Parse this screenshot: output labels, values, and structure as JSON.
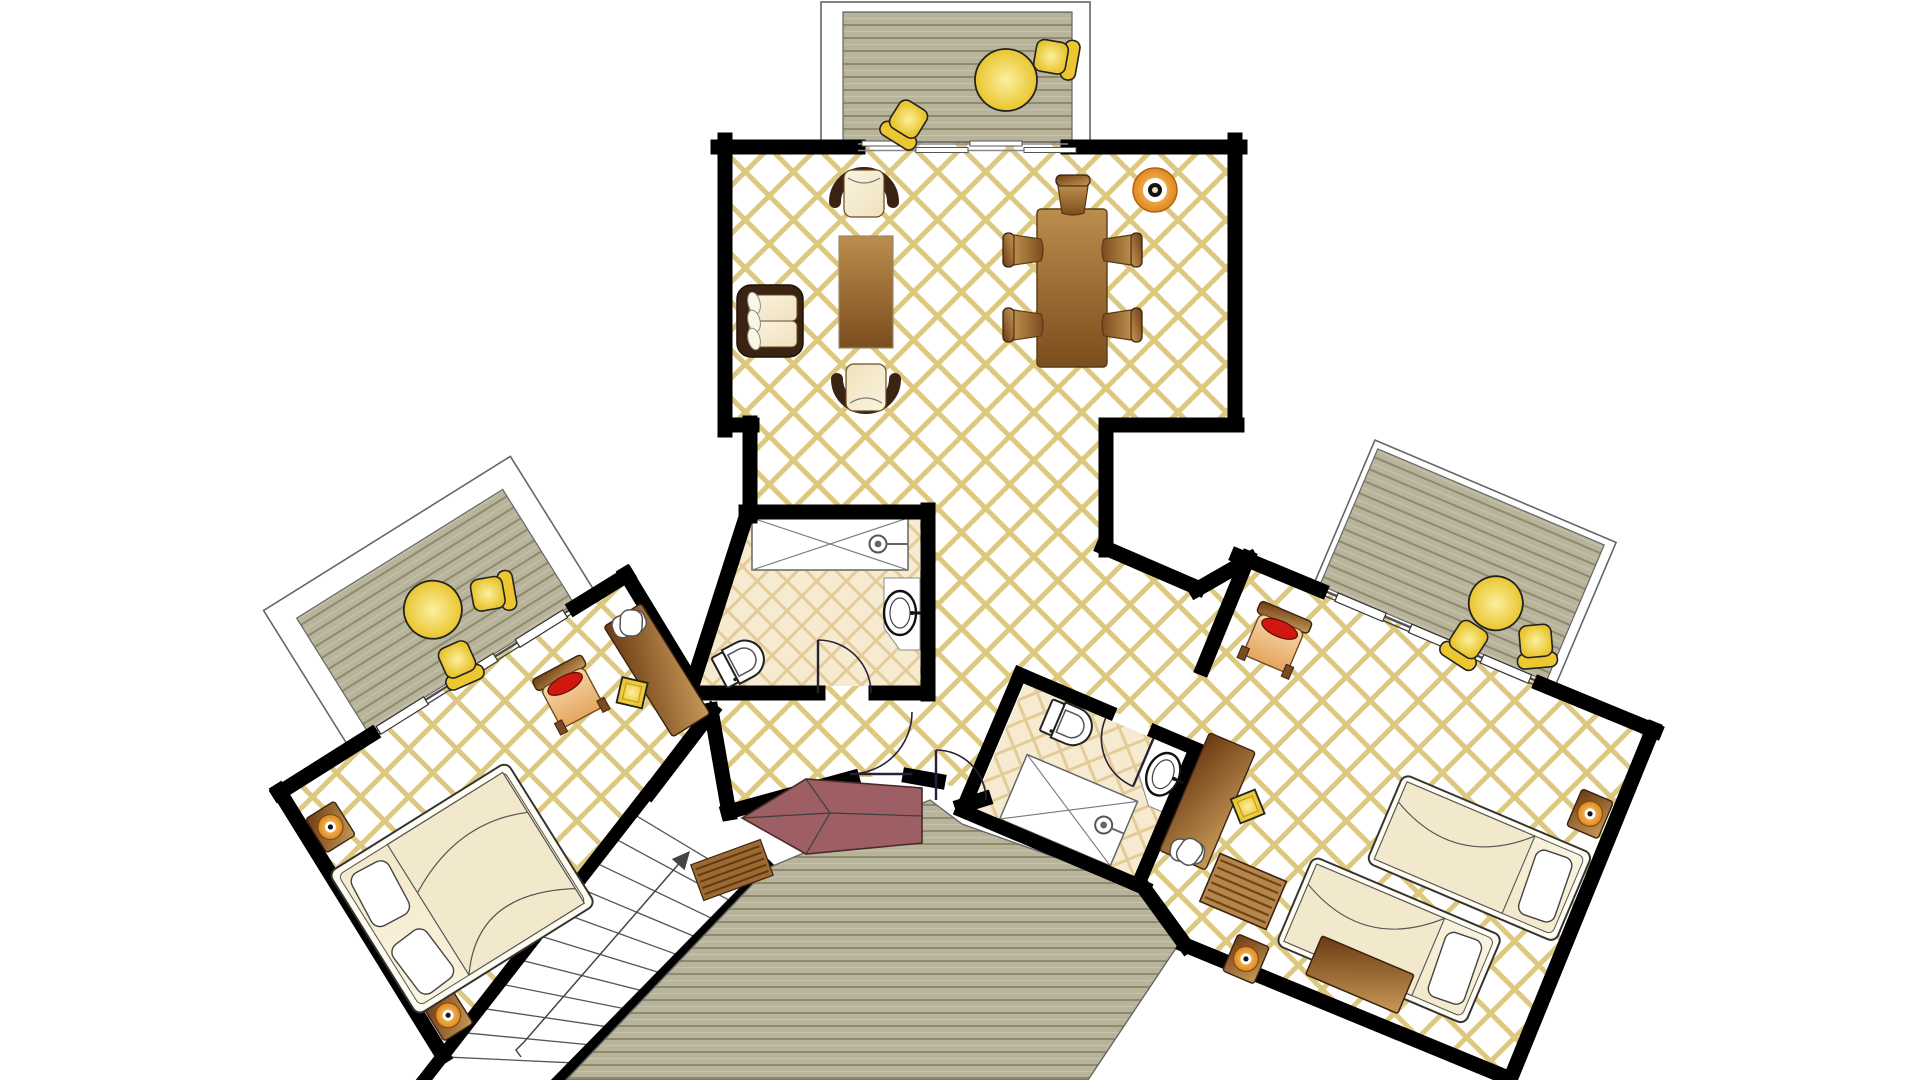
{
  "plan_title": "hotel-suite-floor-plan",
  "canvas": {
    "w": 1920,
    "h": 1080
  },
  "palette": {
    "wall": "#000000",
    "tile_line": "#dcc87e",
    "bath_bg": "#f6ebd1",
    "bath_line": "#e3cc98",
    "deck_bg": "#b8b39b",
    "deck_line": "#8e8a6b",
    "deck_hi": "#c6c2ab",
    "frame_stroke": "#666666",
    "wood_dark": "#3a2312",
    "wood_mid": "#8a5a28",
    "wood_light": "#c89a58",
    "cream_dark": "#efe1bd",
    "cream_light": "#faf4e0",
    "yellow_deep": "#e9c52e",
    "yellow_light": "#fcf0a0",
    "red_cushion": "#d01810",
    "canopy": "#9d5f63",
    "lamp_orange": "#e0871d",
    "arc_stroke": "#2a2038",
    "tread_stroke": "#555555"
  },
  "floors": {
    "main": [
      [
        725,
        140
      ],
      [
        1240,
        140
      ],
      [
        1240,
        430
      ],
      [
        1103,
        430
      ],
      [
        1103,
        548
      ],
      [
        1198,
        588
      ],
      [
        1247,
        561
      ],
      [
        1203,
        666
      ],
      [
        1208,
        752
      ],
      [
        1025,
        674
      ],
      [
        962,
        810
      ],
      [
        986,
        800
      ],
      [
        936,
        780
      ],
      [
        912,
        777
      ],
      [
        850,
        777
      ],
      [
        728,
        812
      ],
      [
        711,
        712
      ],
      [
        687,
        674
      ],
      [
        690,
        693
      ],
      [
        746,
        512
      ],
      [
        750,
        512
      ],
      [
        750,
        430
      ],
      [
        725,
        430
      ]
    ],
    "left_bedroom": [
      [
        279,
        793
      ],
      [
        626,
        576
      ],
      [
        687,
        674
      ],
      [
        711,
        712
      ],
      [
        650,
        790
      ],
      [
        443,
        1055
      ]
    ],
    "right_bedroom": [
      [
        1248,
        560
      ],
      [
        1653,
        732
      ],
      [
        1505,
        1080
      ],
      [
        1183,
        943
      ],
      [
        1144,
        888
      ],
      [
        1205,
        753
      ],
      [
        1203,
        666
      ]
    ]
  },
  "walls": [
    [
      718,
      147,
      858,
      147
    ],
    [
      1068,
      147,
      1240,
      147
    ],
    [
      725,
      140,
      725,
      430
    ],
    [
      725,
      425,
      752,
      425
    ],
    [
      750,
      423,
      750,
      516
    ],
    [
      1235,
      140,
      1235,
      425
    ],
    [
      1237,
      425,
      1106,
      425
    ],
    [
      1106,
      425,
      1106,
      550
    ],
    [
      1103,
      547,
      1198,
      588
    ],
    [
      1196,
      590,
      1250,
      559
    ],
    [
      1238,
      556,
      1320,
      590
    ],
    [
      1541,
      684,
      1655,
      731
    ],
    [
      1653,
      729,
      1510,
      1080
    ],
    [
      1508,
      1078,
      1185,
      945
    ],
    [
      1186,
      946,
      1141,
      884
    ],
    [
      1248,
      558,
      1203,
      668
    ],
    [
      962,
      806,
      984,
      799
    ],
    [
      728,
      812,
      852,
      778
    ],
    [
      910,
      776,
      938,
      781
    ],
    [
      711,
      710,
      729,
      813
    ],
    [
      279,
      793,
      371,
      735
    ],
    [
      575,
      607,
      627,
      575
    ],
    [
      626,
      574,
      688,
      676
    ],
    [
      279,
      791,
      443,
      1056
    ],
    [
      650,
      792,
      712,
      711
    ],
    [
      746,
      512,
      928,
      512
    ],
    [
      928,
      510,
      928,
      694
    ],
    [
      928,
      693,
      876,
      693
    ],
    [
      818,
      693,
      688,
      693
    ],
    [
      747,
      514,
      689,
      695
    ]
  ],
  "stairs": {
    "underlay": [
      [
        650,
        788
      ],
      [
        770,
        866
      ],
      [
        560,
        1082
      ],
      [
        422,
        1082
      ]
    ],
    "edge1": [
      650,
      790,
      424,
      1080
    ],
    "edge2": [
      768,
      868,
      560,
      1080
    ],
    "tread_t": [
      0.08,
      0.164,
      0.248,
      0.332,
      0.416,
      0.5,
      0.584,
      0.668,
      0.752,
      0.836,
      0.92
    ],
    "p_start": [
      650,
      790
    ],
    "p_vec": [
      -226,
      290
    ],
    "q_start": [
      768,
      868
    ],
    "q_vec": [
      -208,
      212
    ],
    "arrow": {
      "line": [
        524,
        1042,
        683,
        859
      ],
      "head": [
        [
          690,
          851
        ],
        [
          684.6,
          870.2
        ],
        [
          671.8,
          859
        ]
      ],
      "tail": [
        [
          524,
          1042
        ],
        [
          516,
          1050
        ],
        [
          521,
          1057
        ]
      ]
    }
  },
  "deck_top": {
    "frame": [
      821,
      2,
      269,
      140
    ],
    "deck": [
      843,
      12,
      229,
      130
    ]
  },
  "deck_bottom": [
    [
      768,
      868
    ],
    [
      930,
      800
    ],
    [
      962,
      824
    ],
    [
      1142,
      888
    ],
    [
      1180,
      942
    ],
    [
      1088,
      1080
    ],
    [
      566,
      1080
    ]
  ],
  "slide_door": {
    "rails": [
      [
        858,
        144,
        1068,
        144
      ],
      [
        858,
        150.5,
        1068,
        150.5
      ]
    ],
    "panels": [
      [
        862,
        141,
        52,
        5
      ],
      [
        916,
        147.5,
        52,
        5
      ],
      [
        970,
        141,
        52,
        5
      ],
      [
        1024,
        147.5,
        52,
        5
      ]
    ]
  },
  "bath1": {
    "floor": [
      [
        748,
        518
      ],
      [
        920,
        518
      ],
      [
        920,
        686
      ],
      [
        696,
        686
      ],
      [
        744,
        518
      ]
    ],
    "shower": [
      752,
      518,
      156,
      52
    ],
    "shower_head": [
      878,
      544
    ],
    "shower_stem": [
      886,
      544,
      908,
      544
    ],
    "vanity": [
      [
        884,
        578
      ],
      [
        920,
        578
      ],
      [
        920,
        650
      ],
      [
        900,
        650
      ],
      [
        884,
        628
      ]
    ],
    "door_leaf": [
      818,
      693,
      818,
      640
    ],
    "door_arc": "M818,640 A53,53 0 0 1 871,693"
  },
  "bath2": {
    "origin": [
      1030,
      671
    ],
    "rot": 23,
    "walls": [
      [
        -8,
        7,
        88,
        7
      ],
      [
        140,
        7,
        190,
        7
      ],
      [
        183,
        7,
        183,
        155
      ],
      [
        190,
        155,
        -8,
        155
      ],
      [
        -8,
        7,
        -8,
        155
      ]
    ],
    "floor": [
      0,
      14,
      183,
      141
    ],
    "shower": [
      30,
      78,
      120,
      70
    ],
    "shower_head": [
      128,
      113
    ],
    "shower_stem": [
      136,
      113,
      150,
      113
    ],
    "vanity": [
      [
        140,
        12
      ],
      [
        183,
        12
      ],
      [
        183,
        78
      ],
      [
        162,
        78
      ],
      [
        140,
        52
      ]
    ],
    "sink": [
      163,
      43
    ],
    "toilet": [
      60,
      34
    ],
    "door_leaf": [
      140,
      14,
      140,
      66
    ],
    "door_arc": "M88,14 A52,52 0 0 0 140,66"
  },
  "hall_doors": [
    {
      "leaf": [
        850,
        774,
        912,
        774
      ],
      "arc": "M850,774 A62,62 0 0 0 912,712"
    },
    {
      "leaf": [
        936,
        750,
        936,
        800
      ],
      "arc": "M936,750 A50,50 0 0 1 986,800"
    }
  ],
  "canopy": {
    "poly": [
      [
        742,
        818
      ],
      [
        806,
        779
      ],
      [
        922,
        788
      ],
      [
        922,
        843
      ],
      [
        806,
        854
      ]
    ],
    "ridges": [
      [
        742,
        818,
        830,
        813
      ],
      [
        806,
        779,
        830,
        813
      ],
      [
        806,
        854,
        830,
        813
      ],
      [
        830,
        813,
        922,
        816
      ]
    ]
  },
  "wing_left": {
    "x": 372,
    "y": 735,
    "rot": -32,
    "frame": [
      -26,
      -163,
      291,
      161
    ],
    "deck": [
      -2,
      -139,
      243,
      135
    ],
    "win_lines": [
      [
        -2,
        -1,
        241,
        -1
      ],
      [
        -2,
        3,
        241,
        3
      ]
    ],
    "sills": [
      [
        8,
        -5,
        56,
        9
      ],
      [
        90,
        -5,
        56,
        9
      ],
      [
        172,
        -5,
        56,
        9
      ]
    ],
    "furniture": [
      {
        "t": "ytable",
        "x": 118,
        "y": -74,
        "r": 0,
        "rad": 29
      },
      {
        "t": "ychair",
        "x": 174,
        "y": -58,
        "r": 112
      },
      {
        "t": "ychair",
        "x": 112,
        "y": -18,
        "r": 188
      },
      {
        "t": "redchair",
        "x": 190,
        "y": 71,
        "r": 4
      },
      {
        "t": "desk",
        "x": 276,
        "y": 96,
        "r": 0,
        "w": 44,
        "h": 130
      },
      {
        "t": "tv",
        "x": 277,
        "y": 42,
        "r": 10
      },
      {
        "t": "stool",
        "x": 243,
        "y": 102,
        "r": 0
      },
      {
        "t": "nightstand",
        "x": -84,
        "y": 56,
        "r": 0
      },
      {
        "t": "nightstand",
        "x": -84,
        "y": 278,
        "r": 0
      },
      {
        "t": "bedd",
        "x": -5,
        "y": 178,
        "r": -90
      }
    ]
  },
  "wing_right": {
    "x": 1248,
    "y": 560,
    "rot": 23,
    "frame": [
      70,
      -160,
      262,
      158
    ],
    "deck": [
      76,
      -153,
      246,
      148
    ],
    "win_lines": [
      [
        76,
        -1,
        322,
        -1
      ],
      [
        76,
        3,
        322,
        3
      ]
    ],
    "sills": [
      [
        96,
        -5,
        52,
        9
      ],
      [
        176,
        -5,
        52,
        9
      ],
      [
        254,
        -5,
        52,
        9
      ]
    ],
    "furniture": [
      {
        "t": "ytable",
        "x": 245,
        "y": -57,
        "r": 0,
        "rad": 27
      },
      {
        "t": "ychair",
        "x": 234,
        "y": -12,
        "r": 190
      },
      {
        "t": "ychair",
        "x": 297,
        "y": -37,
        "r": 152
      },
      {
        "t": "redchair",
        "x": 56,
        "y": 63,
        "r": 0
      },
      {
        "t": "desk",
        "x": 57,
        "y": 238,
        "r": 0,
        "w": 50,
        "h": 128
      },
      {
        "t": "tv",
        "x": 58,
        "y": 292,
        "r": -12
      },
      {
        "t": "stool",
        "x": 96,
        "y": 227,
        "r": 0
      },
      {
        "t": "beds",
        "x": 330,
        "y": 184,
        "r": 90
      },
      {
        "t": "beds",
        "x": 279,
        "y": 295,
        "r": 90
      },
      {
        "t": "nightstand",
        "x": 414,
        "y": 100,
        "r": 0
      },
      {
        "t": "nightstand",
        "x": 154,
        "y": 368,
        "r": 0
      },
      {
        "t": "dresser",
        "x": 265,
        "y": 338,
        "r": 0
      },
      {
        "t": "bench",
        "x": 125,
        "y": 307,
        "r": 0
      }
    ]
  },
  "furniture_main": [
    {
      "t": "sofa",
      "x": 737,
      "y": 285,
      "r": 0
    },
    {
      "t": "armchair",
      "x": 864,
      "y": 190,
      "r": 0
    },
    {
      "t": "armchair",
      "x": 866,
      "y": 391,
      "r": 180
    },
    {
      "t": "coffee",
      "x": 866,
      "y": 292,
      "r": 0,
      "w": 54,
      "h": 112
    },
    {
      "t": "dtable",
      "x": 1072,
      "y": 288,
      "r": 0,
      "w": 70,
      "h": 158
    },
    {
      "t": "dchair",
      "x": 1073,
      "y": 193,
      "r": 0
    },
    {
      "t": "dchair",
      "x": 1021,
      "y": 250,
      "r": -90
    },
    {
      "t": "dchair",
      "x": 1021,
      "y": 325,
      "r": -90
    },
    {
      "t": "dchair",
      "x": 1124,
      "y": 250,
      "r": 90
    },
    {
      "t": "dchair",
      "x": 1124,
      "y": 325,
      "r": 90
    },
    {
      "t": "decor",
      "x": 1155,
      "y": 190,
      "r": 0
    },
    {
      "t": "ytable",
      "x": 1006,
      "y": 80,
      "r": 0,
      "rad": 31
    },
    {
      "t": "ychair",
      "x": 1052,
      "y": 57,
      "r": 100
    },
    {
      "t": "ychair",
      "x": 908,
      "y": 120,
      "r": 212
    },
    {
      "t": "toilet",
      "x": 744,
      "y": 660,
      "r": -28
    },
    {
      "t": "sink",
      "x": 900,
      "y": 613,
      "r": 0
    },
    {
      "t": "mat",
      "x": 732,
      "y": 870,
      "r": -20
    }
  ]
}
